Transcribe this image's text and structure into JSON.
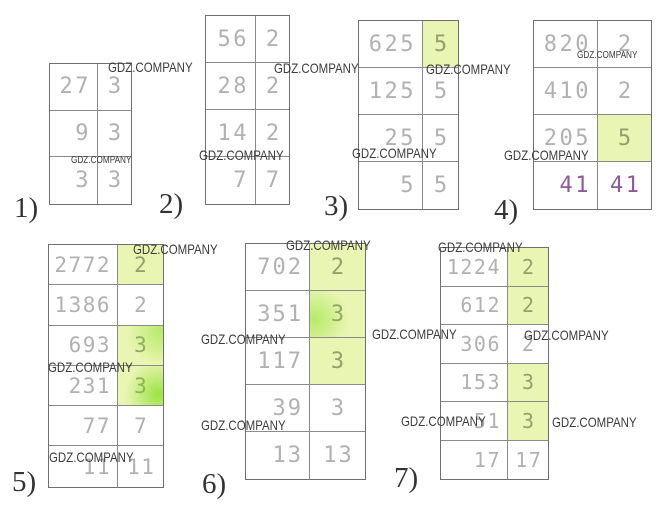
{
  "watermark_text": "GDZ.COMPANY",
  "colors": {
    "highlight_background": "#e9f5b2",
    "digit_normal": "#b1b1b1",
    "digit_highlight": "#93a06e",
    "digit_purple": "#8d5a96",
    "table_border": "#8a8a8a",
    "watermark": "#3c3c3c",
    "label": "#333333"
  },
  "tables": [
    {
      "label": "1)",
      "rows": [
        {
          "left": "27",
          "right": "3"
        },
        {
          "left": "9",
          "right": "3"
        },
        {
          "left": "3",
          "right": "3"
        }
      ]
    },
    {
      "label": "2)",
      "rows": [
        {
          "left": "56",
          "right": "2"
        },
        {
          "left": "28",
          "right": "2"
        },
        {
          "left": "14",
          "right": "2"
        },
        {
          "left": "7",
          "right": "7"
        }
      ]
    },
    {
      "label": "3)",
      "rows": [
        {
          "left": "625",
          "right": "5",
          "highlight": true
        },
        {
          "left": "125",
          "right": "5"
        },
        {
          "left": "25",
          "right": "5"
        },
        {
          "left": "5",
          "right": "5"
        }
      ]
    },
    {
      "label": "4)",
      "rows": [
        {
          "left": "820",
          "right": "2"
        },
        {
          "left": "410",
          "right": "2"
        },
        {
          "left": "205",
          "right": "5",
          "highlight": true
        },
        {
          "left": "41",
          "right": "41",
          "color": "purple"
        }
      ]
    },
    {
      "label": "5)",
      "rows": [
        {
          "left": "2772",
          "right": "2",
          "highlight": true
        },
        {
          "left": "1386",
          "right": "2"
        },
        {
          "left": "693",
          "right": "3",
          "highlight": true,
          "blob": "rt"
        },
        {
          "left": "231",
          "right": "3",
          "highlight": true,
          "blob": "rb"
        },
        {
          "left": "77",
          "right": "7"
        },
        {
          "left": "11",
          "right": "11"
        }
      ]
    },
    {
      "label": "6)",
      "rows": [
        {
          "left": "702",
          "right": "2",
          "highlight": true
        },
        {
          "left": "351",
          "right": "3",
          "highlight": true,
          "blob": "l"
        },
        {
          "left": "117",
          "right": "3",
          "highlight": true
        },
        {
          "left": "39",
          "right": "3"
        },
        {
          "left": "13",
          "right": "13"
        }
      ]
    },
    {
      "label": "7)",
      "rows": [
        {
          "left": "1224",
          "right": "2",
          "highlight": true
        },
        {
          "left": "612",
          "right": "2",
          "highlight": true
        },
        {
          "left": "306",
          "right": "2"
        },
        {
          "left": "153",
          "right": "3",
          "highlight": true
        },
        {
          "left": "51",
          "right": "3",
          "highlight": true
        },
        {
          "left": "17",
          "right": "17"
        }
      ]
    }
  ],
  "watermarks": [
    {
      "x": 108,
      "y": 60,
      "size": 14
    },
    {
      "x": 71,
      "y": 156,
      "size": 10
    },
    {
      "x": 274,
      "y": 61,
      "size": 14
    },
    {
      "x": 199,
      "y": 148,
      "size": 14
    },
    {
      "x": 426,
      "y": 62,
      "size": 14
    },
    {
      "x": 352,
      "y": 146,
      "size": 14
    },
    {
      "x": 577,
      "y": 51,
      "size": 10
    },
    {
      "x": 504,
      "y": 148,
      "size": 14
    },
    {
      "x": 133,
      "y": 242,
      "size": 14
    },
    {
      "x": 48,
      "y": 360,
      "size": 14
    },
    {
      "x": 49,
      "y": 450,
      "size": 14
    },
    {
      "x": 286,
      "y": 238,
      "size": 14
    },
    {
      "x": 201,
      "y": 332,
      "size": 14
    },
    {
      "x": 201,
      "y": 418,
      "size": 14
    },
    {
      "x": 372,
      "y": 327,
      "size": 14
    },
    {
      "x": 401,
      "y": 414,
      "size": 14
    },
    {
      "x": 438,
      "y": 240,
      "size": 14
    },
    {
      "x": 524,
      "y": 328,
      "size": 14
    },
    {
      "x": 552,
      "y": 415,
      "size": 14
    }
  ]
}
